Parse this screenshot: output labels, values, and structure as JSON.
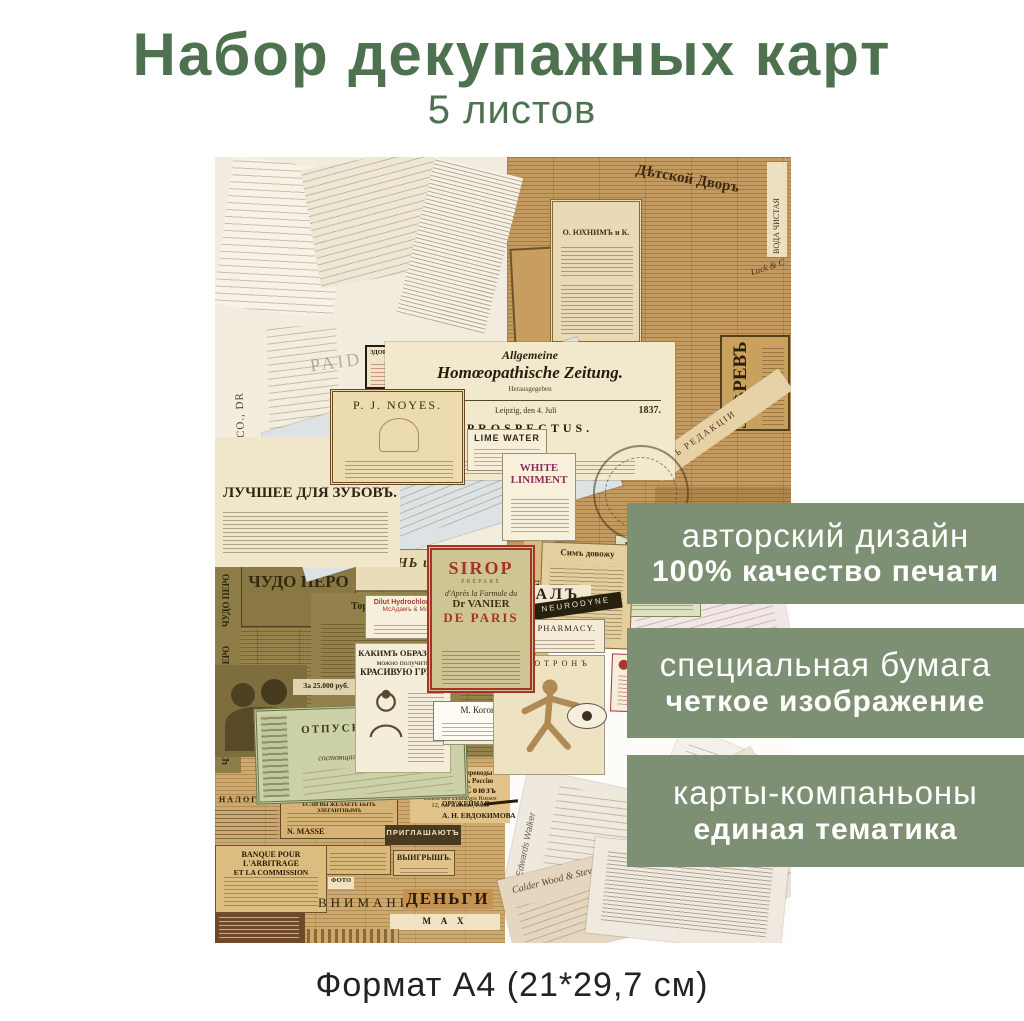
{
  "header": {
    "title": "Набор декупажных карт",
    "subtitle": "5 листов"
  },
  "footer": {
    "format": "Формат А4 (21*29,7 см)"
  },
  "banners": [
    {
      "line1": "авторский дизайн",
      "line2": "100% качество печати"
    },
    {
      "line1": "специальная бумага",
      "line2": "четкое изображение"
    },
    {
      "line1": "карты-компаньоны",
      "line2": "единая тематика"
    }
  ],
  "colors": {
    "title_green": "#4e7150",
    "banner_green": "#7d9073",
    "caption_text": "#222222",
    "sepia_paper": "#c59a5e",
    "olive_paper": "#95834c",
    "tan_paper": "#cda96d",
    "cream_paper": "#f2ecdf"
  },
  "icons": {
    "hand": "☛",
    "eye": "eye-ellipse-shape",
    "crow": "crow-silhouette-svg",
    "woman": "woman-portrait-svg",
    "anatomy_man": "anatomical-figure-svg",
    "seal": "round-stamp-rings",
    "rifle": "rifle-bar-shape"
  },
  "collage": {
    "ephemera": {
      "newton": "TO J. E. NEWTON CO., DR",
      "brigham": "BRIGHAM, JONES & CO.",
      "rogers": "ROGERS & HOPKINSON CO.",
      "paid": "PAID",
      "kuzmin": "Кузьминъ",
      "detskoy": "Дѣтской Дворъ",
      "yuhin": "О. ЮХНИМЪ и К.",
      "vrach": "ВРАЧЪ",
      "zverev": "ЗВѢРЕВЪ",
      "istochnik": "ИСТОЧНИКЪ БОГАТСТВА!",
      "voda": "ВОДА ЧИСТАЯ",
      "luck": "Luck & C",
      "redakcii": "ОТЪ РЕДАКЦІИ",
      "zdorovye_ad": "ЗДОРОВЬЕ САМОЕ ЦѢННОЕ ДЛЯ ВСѢХЪ!",
      "zeitung1": "Allgemeine",
      "zeitung2": "Homœopathische Zeitung.",
      "zeitung3": "Herausgegeben",
      "zeitung_no": "№ 1.",
      "zeitung_place": "Leipzig, den 4. Juli",
      "zeitung_year": "1837.",
      "prospectus": "PROSPECTUS.",
      "noyes": "P. J. NOYES.",
      "lime": "LIME WATER",
      "liniment1": "WHITE",
      "liniment2": "LINIMENT",
      "sirop1": "SIROP",
      "sirop2": "PRÉPARÉ",
      "sirop3": "d'Après la Formule du",
      "sirop4": "Dr VANIER",
      "sirop5": "DE PARIS",
      "luchshee": "ЛУЧШЕЕ ДЛЯ ЗУБОВЪ.",
      "sim": "Симъ довожу",
      "borj": "минеральная вода БОРЖ",
      "zhurnal": "ЖУРНАЛЪ,",
      "kogon": "М. Когонъ",
      "neurodyne": "NEURODYNE",
      "hemen": "HEMEN PHARMACY.",
      "katotron": "КАТОТРОНЪ",
      "croix": "CROIX ROUGE",
      "cod": "COD LIVER OIL.",
      "chudo": "ЧУДО ПЕРО",
      "torgovy": "Торговый домъ",
      "rub25000": "За 25.000 руб.",
      "zhizn": "ЖИЗНЬ и ЗДОРОВЬЕ",
      "acid1": "Dilut Hydrochloric Acid",
      "acid2": "МсАдамъ & Мосово",
      "sanatorny": "Санаторный",
      "kakim1": "КАКИМЪ ОБРАЗОМЪ",
      "kakim2": "можно получить",
      "kakim3": "КРАСИВУЮ ГРУДЬ.",
      "otpusknoy1": "ОТПУСКНОЙ БИЛЕТЪ",
      "otpusknoy2": "для",
      "otpusknoy3": "состоящаго въ супруж.",
      "nalogi": "НАЛОГИ",
      "elegant": "ЕСЛИ ВЫ ЖЕЛАЕТЕ БЫТЬ ЭЛЕГАНТНЫМЪ",
      "masse": "N. MASSE",
      "dengi_zem0": "Денежные переводы",
      "zemsky1": "и посылки въ Россію",
      "zemsky2": "Земскій Союзъ",
      "zemsky3": "Union des Zemstvos Russes",
      "zemsky4": "12, rue Blanche, Paris",
      "priglashayut": "ПРИГЛАШАЮТЪ",
      "oruzheynaya": "ОРУЖЕЙНАЯ",
      "evdokimova": "А. Н. ЕВДОКИМОВА",
      "vyigrysh": "ВЫИГРЫШЪ.",
      "foto": "ФОТО",
      "banque1": "BANQUE POUR L'ARBITRAGE",
      "banque2": "ET LA COMMISSION",
      "vnimaniyu": "ВНИМАНИЮ",
      "dengi": "ДЕНЬГИ",
      "max": "M A X",
      "edwards": "Edwards Walker",
      "calder": "Calder Wood & Stevens Co"
    }
  }
}
